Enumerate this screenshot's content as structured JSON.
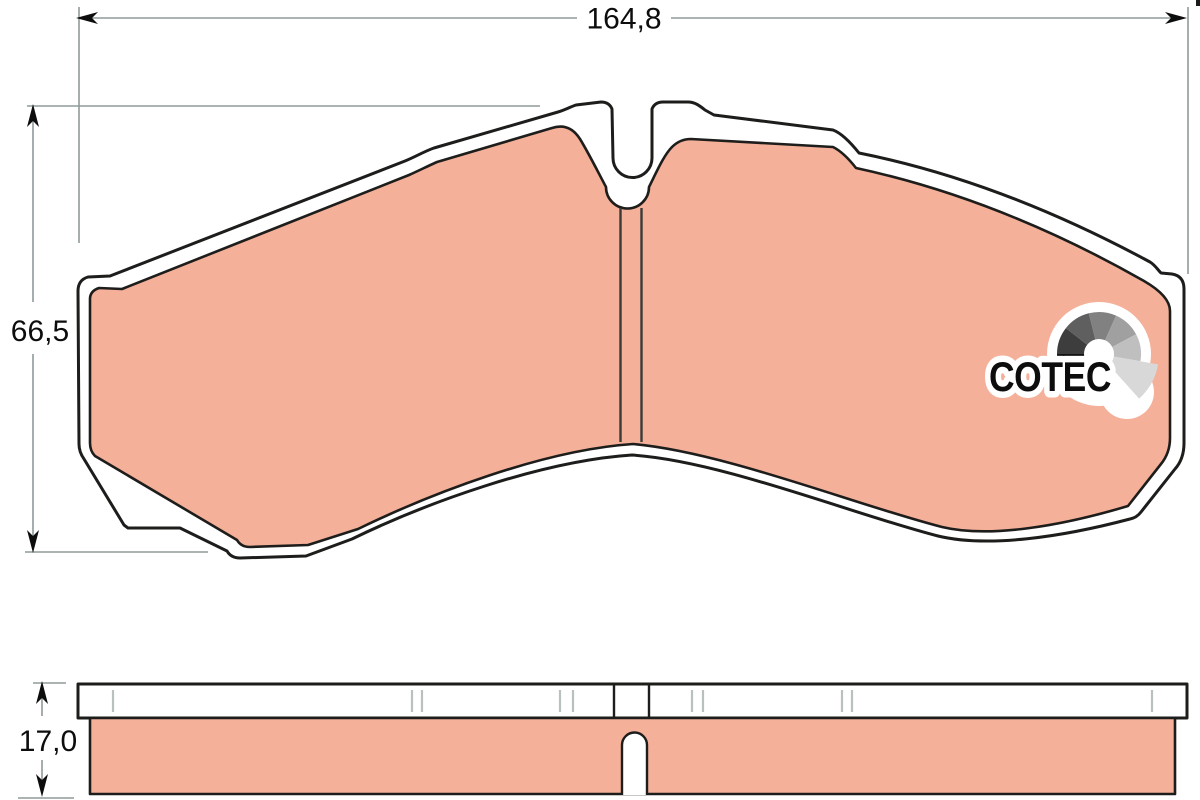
{
  "drawing": {
    "dimension_labels": {
      "width": "164,8",
      "height": "66,5",
      "thickness": "17,0"
    }
  },
  "logo": {
    "brand": "COTEC",
    "fan_colors": [
      "#141414",
      "#3d3d3d",
      "#5f5f5f",
      "#818181",
      "#a0a0a0",
      "#bfbfbf",
      "#d8d8d8"
    ]
  },
  "colors": {
    "background": "#ffffff",
    "friction": "#f5b09a",
    "outline": "#1d1d1b",
    "dimline": "#8f9a9a",
    "tick": "#b9c0c0",
    "text": "#0d0d0d"
  }
}
